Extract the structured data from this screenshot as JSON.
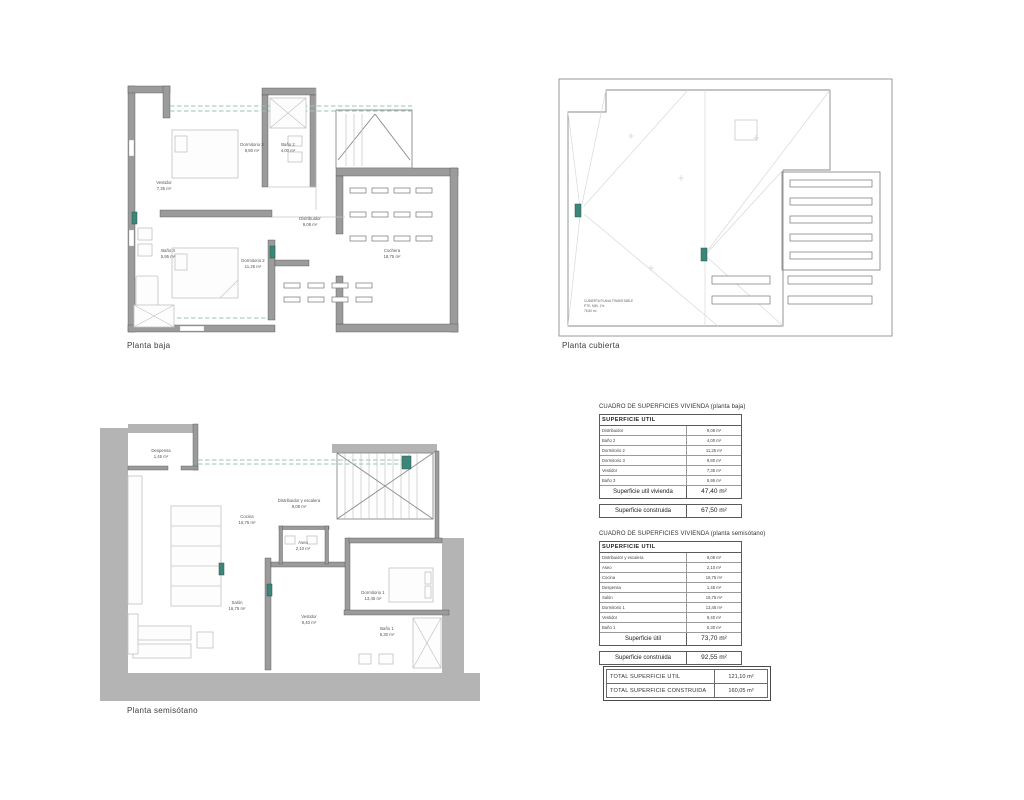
{
  "page": {
    "background": "#ffffff",
    "accent_teal": "#3d8578",
    "wall_gray": "#9b9b9b",
    "band_gray": "#b4b4b4"
  },
  "plans": {
    "baja": {
      "title": "Planta baja",
      "rooms": [
        {
          "name": "Dormitorio 3",
          "area": "9,80 m²"
        },
        {
          "name": "Baño 2",
          "area": "4,00 m²"
        },
        {
          "name": "Vestidor",
          "area": "7,35 m²"
        },
        {
          "name": "Baño 3",
          "area": "5,95 m²"
        },
        {
          "name": "Dormitorio 2",
          "area": "11,25 m²"
        },
        {
          "name": "Distribuidor",
          "area": "9,08 m²"
        },
        {
          "name": "Cochera",
          "area": "18,75 m²"
        }
      ]
    },
    "cubierta": {
      "title": "Planta cubierta",
      "note_line1": "CUBIERTA PLANA TRANSITABLE",
      "note_line2": "PTE. MIN. 1%",
      "note_line3": "76,80 m²"
    },
    "semisotano": {
      "title": "Planta semisótano",
      "rooms": [
        {
          "name": "Despensa",
          "area": "1,45 m²"
        },
        {
          "name": "Cocina",
          "area": "16,75 m²"
        },
        {
          "name": "Distribuidor y escalera",
          "area": "9,08 m²"
        },
        {
          "name": "Aseo",
          "area": "2,10 m²"
        },
        {
          "name": "Salón",
          "area": "16,75 m²"
        },
        {
          "name": "Vestidor",
          "area": "9,40 m²"
        },
        {
          "name": "Dormitorio 1",
          "area": "13,45 m²"
        },
        {
          "name": "Baño 1",
          "area": "5,30 m²"
        }
      ]
    }
  },
  "tables": {
    "baja": {
      "title": "CUADRO DE SUPERFICIES VIVIENDA (planta baja)",
      "header": "SUPERFICIE  UTIL",
      "rows": [
        {
          "label": "Distribuidor",
          "value": "9,08 m²"
        },
        {
          "label": "Baño 2",
          "value": "4,00 m²"
        },
        {
          "label": "Dormitorio 2",
          "value": "11,25 m²"
        },
        {
          "label": "Dormitorio 3",
          "value": "9,80 m²"
        },
        {
          "label": "Vestidor",
          "value": "7,35 m²"
        },
        {
          "label": "Baño 3",
          "value": "5,95 m²"
        }
      ],
      "subtotal_label": "Superficie util vivienda",
      "subtotal_value": "47,40 m²",
      "construida_label": "Superficie construida",
      "construida_value": "67,50 m²"
    },
    "semisotano": {
      "title": "CUADRO DE SUPERFICIES VIVIENDA (planta semisótano)",
      "header": "SUPERFICIE  UTIL",
      "rows": [
        {
          "label": "Distribuidor y escalera",
          "value": "9,08 m²"
        },
        {
          "label": "Aseo",
          "value": "2,10 m²"
        },
        {
          "label": "Cocina",
          "value": "16,75 m²"
        },
        {
          "label": "Despensa",
          "value": "1,45 m²"
        },
        {
          "label": "Salón",
          "value": "16,75 m²"
        },
        {
          "label": "Dormitorio 1",
          "value": "13,45 m²"
        },
        {
          "label": "Vestidor",
          "value": "9,40 m²"
        },
        {
          "label": "Baño 1",
          "value": "5,30 m²"
        }
      ],
      "subtotal_label": "Superficie útil",
      "subtotal_value": "73,70 m²",
      "construida_label": "Superficie construida",
      "construida_value": "92,55 m²"
    },
    "totals": {
      "util_label": "TOTAL SUPERFICIE  UTIL",
      "util_value": "121,10 m²",
      "construida_label": "TOTAL SUPERFICIE  CONSTRUIDA",
      "construida_value": "160,05 m²"
    }
  }
}
